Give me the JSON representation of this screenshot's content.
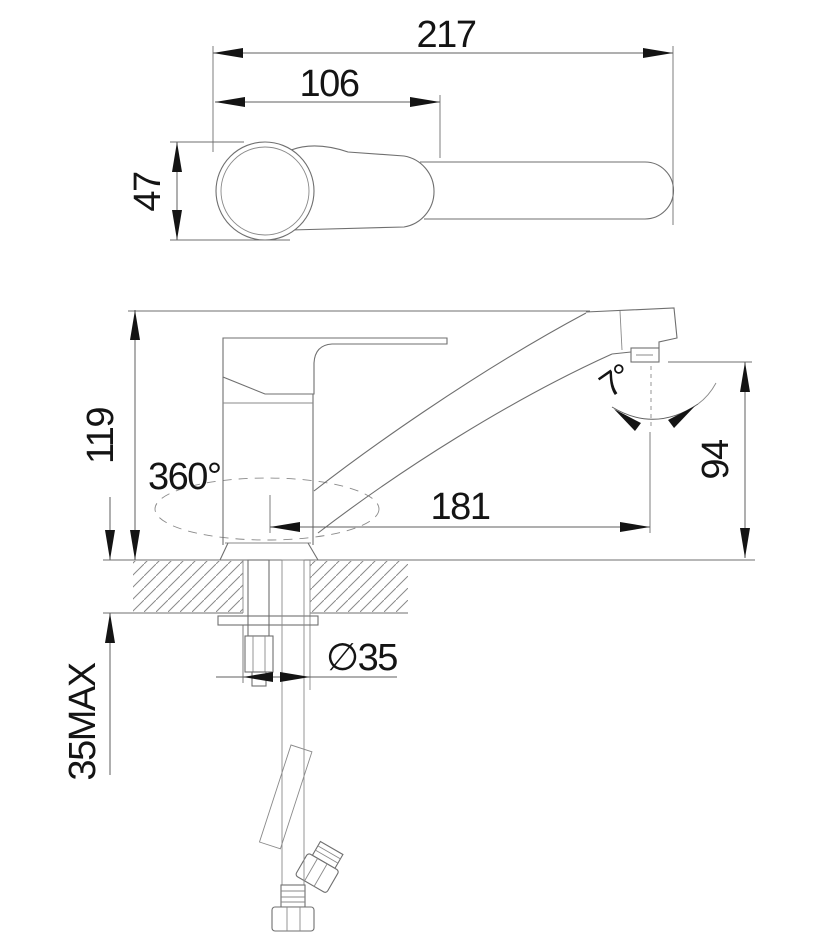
{
  "dimensions": {
    "overall_length": "217",
    "handle_length": "106",
    "body_width": "47",
    "height_to_spout_top": "119",
    "swivel_range": "360°",
    "spout_reach": "181",
    "outlet_angle": "7°",
    "outlet_height": "94",
    "mounting_hole_diameter": "∅35",
    "max_deck_thickness": "35MAX"
  },
  "colors": {
    "background": "#ffffff",
    "line": "#6f6f6f",
    "text": "#141414"
  }
}
